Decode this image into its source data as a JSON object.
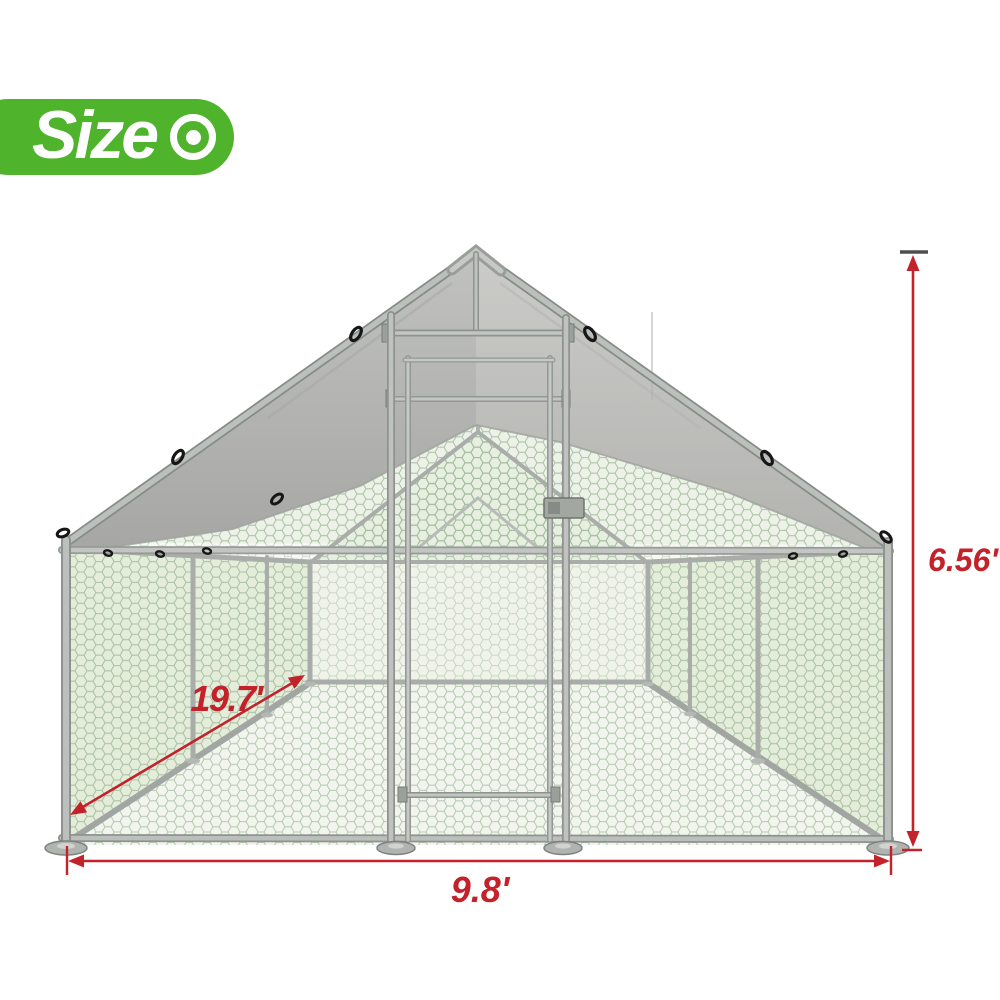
{
  "badge": {
    "label": "Size",
    "icon": "target-icon",
    "background_color": "#4fb32b",
    "text_color": "#ffffff"
  },
  "dimensions": {
    "annotation_color": "#c3222a",
    "height": "6.56'",
    "width": "9.8'",
    "depth": "19.7'"
  },
  "illustration": {
    "subject": "galvanized-metal walk-in chicken run with peaked gray tarp roof, hexagonal wire mesh walls and front lockable door",
    "colors": {
      "tarp_left": "#aeafac",
      "tarp_right": "#c0c0bd",
      "frame_metal": "#b9bcb9",
      "mesh_line": "#a9bfa4",
      "interior_tint": "#e4edda",
      "clip_black": "#161616"
    }
  }
}
